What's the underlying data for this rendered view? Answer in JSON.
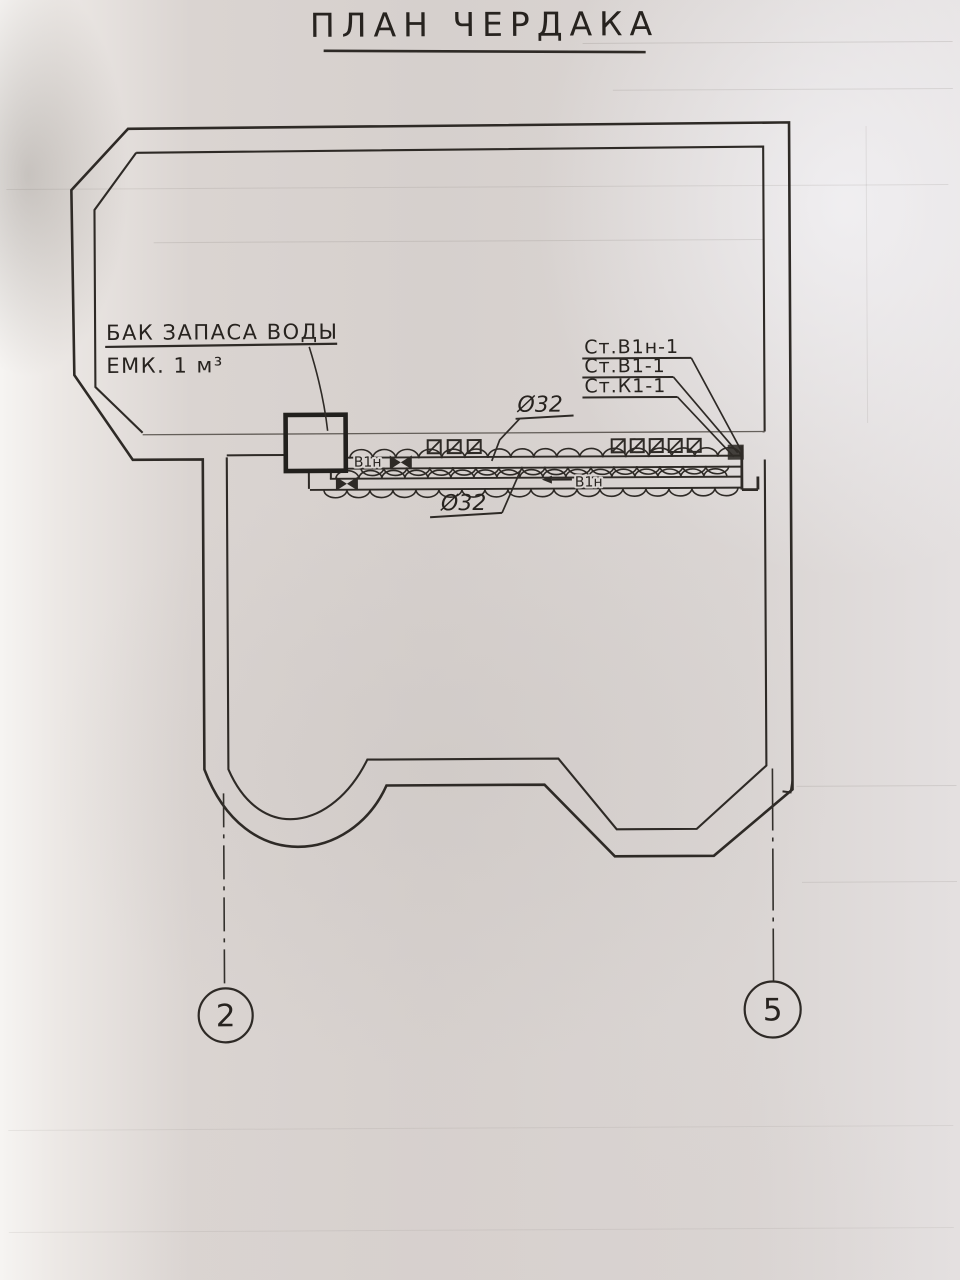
{
  "document": {
    "title": "ПЛАН ЧЕРДАКА",
    "type_note": "scanned hand-drawn attic plumbing plan"
  },
  "annotations": {
    "tank_label_line1": "БАК ЗАПАСА ВОДЫ",
    "tank_label_line2": "ЕМК. 1 м³",
    "riser_labels": [
      "Ст.В1н-1",
      "Ст.В1-1",
      "Ст.К1-1"
    ],
    "pipe_diameter_top": "Ø32",
    "pipe_diameter_bottom": "Ø32",
    "pipe_tag_upper": "В1н",
    "pipe_tag_lower": "В1н"
  },
  "axes": {
    "left_bubble": "2",
    "right_bubble": "5"
  },
  "colors": {
    "ink": "#2e2a26",
    "paper": "#d8d3d0"
  }
}
